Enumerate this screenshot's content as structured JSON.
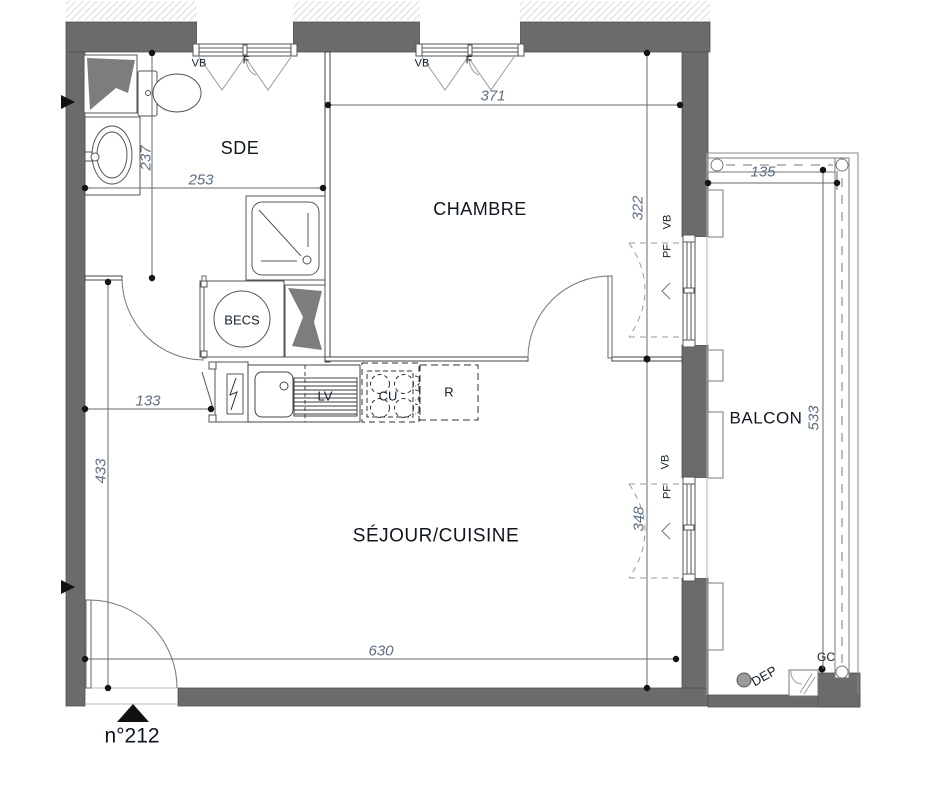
{
  "plan": {
    "unit_label": "n°212",
    "rooms": {
      "sde": "SDE",
      "chambre": "CHAMBRE",
      "sejour": "SÉJOUR/CUISINE",
      "balcon": "BALCON"
    },
    "fixtures": {
      "becs": "BECS",
      "lv": "LV",
      "cu": "CU",
      "r": "R",
      "gc": "GC",
      "dep": "DEP"
    },
    "openings": {
      "vb": "VB",
      "f": "F",
      "pf": "PF"
    },
    "dimensions": {
      "sde_width": "253",
      "sde_depth": "237",
      "chambre_width": "371",
      "chambre_depth": "322",
      "balcon_width": "135",
      "balcon_depth": "533",
      "entry_width": "133",
      "sejour_depth": "433",
      "sejour_window_offset": "348",
      "sejour_width": "630"
    },
    "colors": {
      "wall": "#6b6b6b",
      "label": "#14202c",
      "dimension": "#5d6f83"
    }
  }
}
